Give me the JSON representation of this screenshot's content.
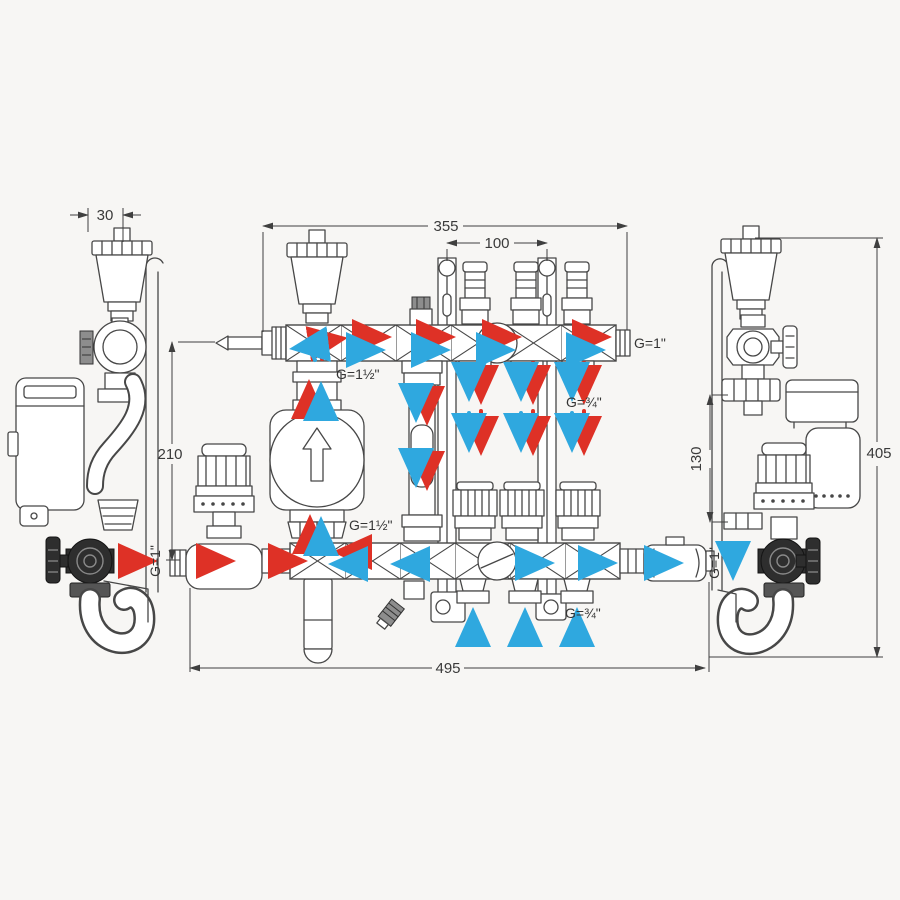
{
  "dims": {
    "d30": "30",
    "d355": "355",
    "d100": "100",
    "d405": "405",
    "d210": "210",
    "d130": "130",
    "d495": "495"
  },
  "ports": {
    "supply_main": "G=1½\"",
    "pump_union": "G=1½\"",
    "supply_end": "G=1\"",
    "supply_loop": "G=¾\"",
    "return_loop": "G=¾\"",
    "return_inlet": "G=1\"",
    "return_outlet": "G=1\""
  },
  "colors": {
    "supply_flow": "#de3126",
    "return_flow": "#2fa8df",
    "line": "#474747",
    "background": "#f7f6f4"
  }
}
